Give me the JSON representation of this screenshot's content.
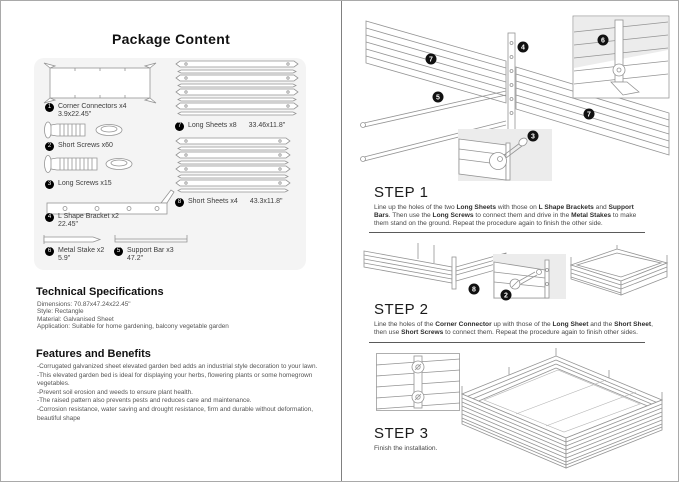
{
  "left": {
    "title": "Package Content",
    "items": [
      {
        "num": "1",
        "label": "Corner Connectors x4",
        "size": "3.9x22.45\""
      },
      {
        "num": "2",
        "label": "Short Screws x60",
        "size": ""
      },
      {
        "num": "3",
        "label": "Long Screws x15",
        "size": ""
      },
      {
        "num": "4",
        "label": "L Shape Bracket x2",
        "size": "22.45\""
      },
      {
        "num": "6",
        "label": "Metal Stake x2",
        "size": "5.9\""
      },
      {
        "num": "5",
        "label": "Support Bar x3",
        "size": "47.2\""
      },
      {
        "num": "7",
        "label": "Long Sheets x8",
        "size": "33.46x11.8\""
      },
      {
        "num": "8",
        "label": "Short Sheets x4",
        "size": "43.3x11.8\""
      }
    ],
    "tech_specs": {
      "heading": "Technical Specifications",
      "lines": [
        "Dimensions:  70.87x47.24x22.45\"",
        "Style: Rectangle",
        "Material: Galvanised Sheet",
        "Application: Suitable for home gardening, balcony vegetable garden"
      ]
    },
    "features": {
      "heading": "Features and Benefits",
      "lines": [
        "-Corrugated galvanized sheet elevated garden bed adds an industrial style decoration to your lawn.",
        "-This elevated garden bed is ideal for displaying your herbs, flowering plants or some homegrown vegetables.",
        "-Prevent soil erosion and weeds to ensure plant health.",
        "-The raised pattern also prevents pests and reduces care and maintenance.",
        "-Corrosion resistance, water saving and drought resistance, firm and durable without deformation, beautiful shape"
      ]
    }
  },
  "right": {
    "steps": [
      {
        "heading": "STEP 1",
        "body": [
          {
            "text": "Line up the holes of the two ",
            "bold": false
          },
          {
            "text": "Long Sheets",
            "bold": true
          },
          {
            "text": " with those on ",
            "bold": false
          },
          {
            "text": "L Shape Brackets",
            "bold": true
          },
          {
            "text": " and ",
            "bold": false
          },
          {
            "text": "Support Bars",
            "bold": true
          },
          {
            "text": ". Then use the ",
            "bold": false
          },
          {
            "text": "Long Screws",
            "bold": true
          },
          {
            "text": " to connect them and drive in the ",
            "bold": false
          },
          {
            "text": "Metal Stakes",
            "bold": true
          },
          {
            "text": " to make them stand on the ground. Repeat the procedure again to finish the other side.",
            "bold": false
          }
        ]
      },
      {
        "heading": "STEP 2",
        "body": [
          {
            "text": "Line the holes of the ",
            "bold": false
          },
          {
            "text": "Corner Connector",
            "bold": true
          },
          {
            "text": " up with those of the ",
            "bold": false
          },
          {
            "text": "Long Sheet",
            "bold": true
          },
          {
            "text": " and the ",
            "bold": false
          },
          {
            "text": "Short Sheet",
            "bold": true
          },
          {
            "text": ", then use ",
            "bold": false
          },
          {
            "text": "Short Screws",
            "bold": true
          },
          {
            "text": " to connect them. Repeat the procedure again to finish other sides.",
            "bold": false
          }
        ]
      },
      {
        "heading": "STEP 3",
        "body": [
          {
            "text": "Finish the installation.",
            "bold": false
          }
        ]
      }
    ],
    "callouts": {
      "step1": {
        "left_sheet": "7",
        "bracket": "4",
        "support_bar": "5",
        "right_sheet": "7",
        "stake_inset": "6",
        "screw_inset": "3"
      },
      "step2": {
        "corner_assembly": "8",
        "screw_inset": "2"
      }
    }
  }
}
